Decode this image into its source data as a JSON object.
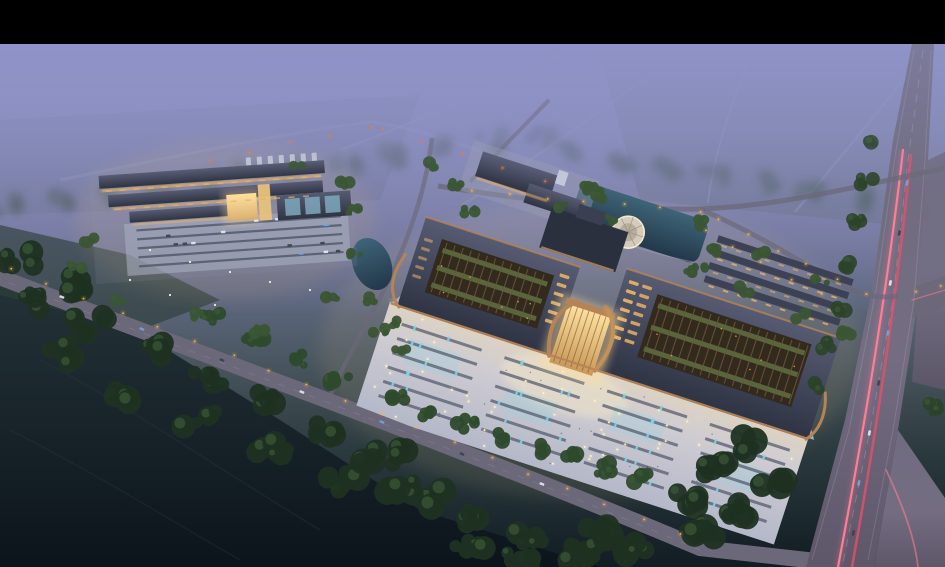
{
  "scene": {
    "description": "Aerial dusk rendering of a large traditional-eave exhibition and trade complex with illuminated plaza, pond with circular fountain terrace, secondary market hall cluster, forests, farm fields in purple fog, and a highway with car light trails",
    "regions": {
      "letterbox": "black bar across top of frame",
      "far_landscape": "fog-covered farm fields with faint country roads and tree lines",
      "left_complex": "secondary hall cluster with warm lit facades and front parking lot",
      "main_complex": "two large dark-roofed halls with open lattice courtyards joined by a glowing central atrium",
      "plaza": "illuminated paved forecourt with parking rows, teal water features and light points",
      "pond": "reflecting pond with circular fountain terrace",
      "back_rows": "rows of long dormitory buildings with amber windows",
      "front_road": "tree-lined avenue with street lamps crossing the foreground",
      "highway": "multi-lane highway with pink car light trails and side ramps",
      "forest": "dark woodland and fields in the lower left foreground"
    }
  },
  "palette": {
    "frame": "#000000",
    "fog_top": "#8f93c7",
    "fog_mid": "#7c80a9",
    "haze": "#646d85",
    "ground_far": "#49565a",
    "ground_dark": "#1a262c",
    "field_black": "#0c141b",
    "tree_dark": "#1f3122",
    "tree_mid": "#2c4229",
    "tree_site": "#3a5534",
    "road": "#6b6879",
    "road_light": "#9a9ebc",
    "hwy": "#716d80",
    "lane": "#c0bed0",
    "plaza": "#c9c8d4",
    "plaza_warm": "#ddd3c2",
    "strip": "#4e5566",
    "teal": "#86d4e4",
    "roof": "#3f4458",
    "roof_hi": "#596078",
    "bronze": "#b58355",
    "amber": "#e8b264",
    "glass": "#ffdf9c",
    "glow_warm": "#ffeebc",
    "court": "#332a1e",
    "lattice": "#6e5539",
    "green_row": "#5c6e3e",
    "pond": "#2c4a5e",
    "pond_hi": "#3f6478",
    "colonnade": "#a9bccd",
    "trail_pink": "#ff7d95",
    "trail_red": "#e84f6a",
    "lamp": "#f5b54a",
    "lamp_far": "#e87f35",
    "car_white": "#e6ebf2",
    "car_blue": "#7aa2d8",
    "white_light": "#fff4d2"
  }
}
